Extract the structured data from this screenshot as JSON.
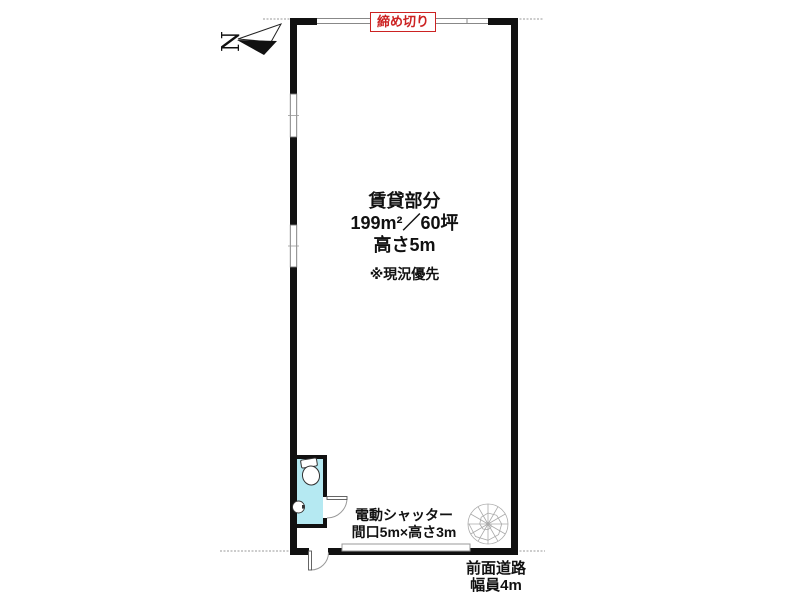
{
  "floorplan": {
    "compass": {
      "north_label": "N"
    },
    "top_opening_label": "締め切り",
    "unit_info": {
      "title": "賃貸部分",
      "area": "199m²／60坪",
      "height": "高さ5m",
      "note": "※現況優先"
    },
    "shutter_label": {
      "line1": "電動シャッター",
      "line2": "間口5m×高さ3m"
    },
    "road_label": {
      "line1": "前面道路",
      "line2": "幅員4m"
    },
    "colors": {
      "wall": "#111111",
      "thin_line": "#999999",
      "toilet_fill": "#b5e9f2",
      "accent_red": "#cc2222",
      "stair_line": "#aaaaaa"
    },
    "icons": {
      "north_arrow": "north-arrow-icon",
      "toilet": "toilet-icon",
      "hand_basin": "hand-basin-icon",
      "spiral_staircase": "spiral-staircase-icon"
    }
  }
}
